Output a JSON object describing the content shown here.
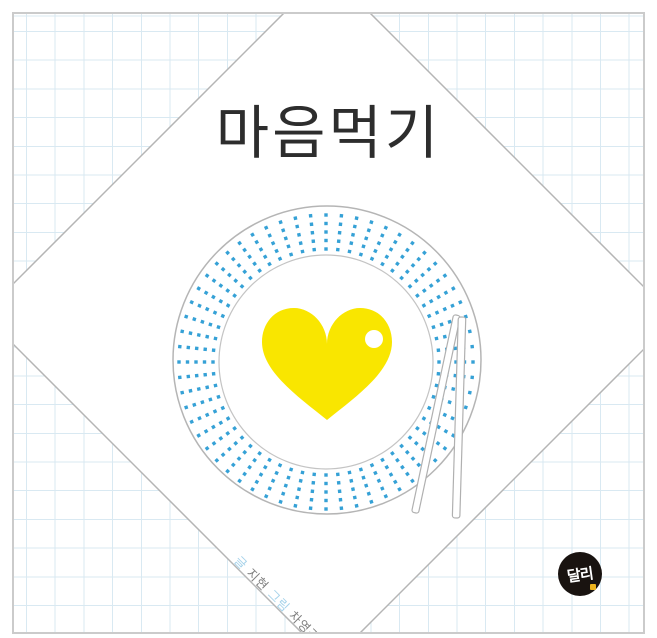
{
  "cover": {
    "title": "마음먹기",
    "credits": {
      "writer_label": "글",
      "writer_name": " 지현 ",
      "illustrator_label": "그림",
      "illustrator_name": " 차영경"
    },
    "logo_text": "달리"
  },
  "colors": {
    "accent_yellow": "#f9e600",
    "dot_blue": "#35a1d6",
    "grid_blue": "#d9e9f2",
    "credit_blue": "#a5d2ea",
    "credit_gray": "#7f7f7f",
    "logo_black": "#191310",
    "logo_accent": "#eeb31c",
    "title_color": "#2d2d2d"
  }
}
